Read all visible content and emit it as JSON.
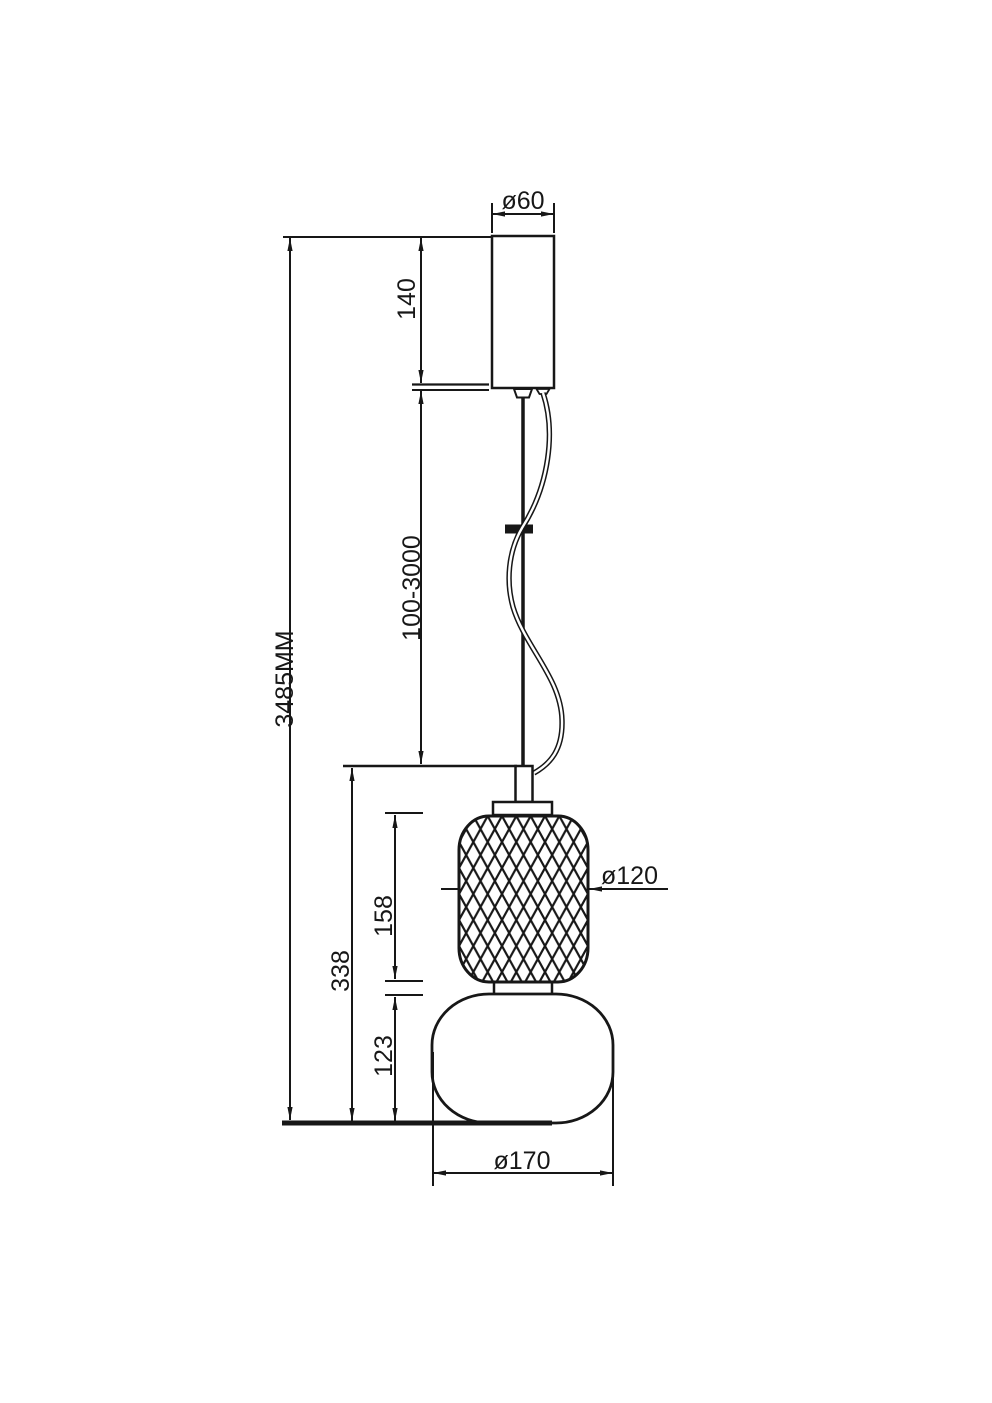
{
  "page": {
    "background": "#ffffff",
    "line_color": "#171717"
  },
  "drawing": {
    "type": "technical-dimension-drawing",
    "labels": {
      "canopy_diameter": "ø60",
      "canopy_height": "140",
      "overall_height": "3485MM",
      "suspension_length_range": "100-3000",
      "fixture_body_height": "338",
      "upper_shade_height": "158",
      "upper_shade_diameter": "ø120",
      "lower_shade_height": "123",
      "lower_shade_diameter": "ø170"
    }
  }
}
